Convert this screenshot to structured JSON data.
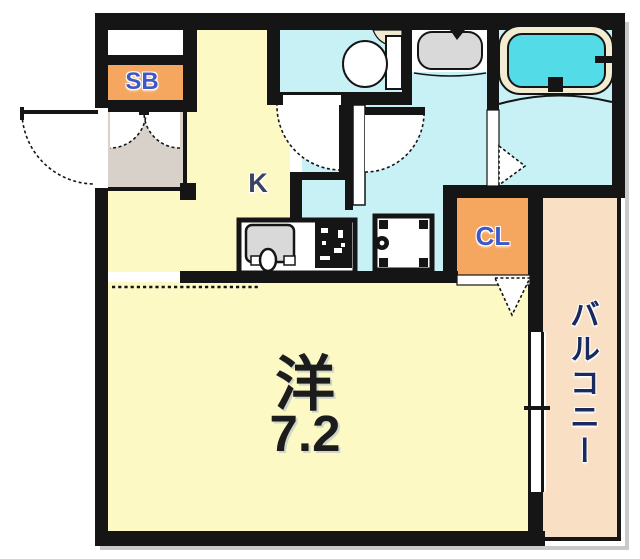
{
  "floor_plan": {
    "unit_labels": {
      "shoe_box": "SB",
      "kitchen": "K",
      "closet": "CL",
      "main_room_type": "洋",
      "main_room_size": "7.2",
      "balcony": "バルコニー"
    },
    "colors": {
      "wall": "#151515",
      "room_yellow": "#FCF9C5",
      "water_cyan": "#C8F1F6",
      "tub_water": "#54DBE8",
      "tub_rim": "#F1ECD2",
      "unit_orange": "#F5A75F",
      "balcony_peach": "#F9DFC3",
      "genkan_gray": "#D8D1CA",
      "fixture_gray": "#D9D9D9",
      "toilet_beige": "#EFE9D2",
      "shadow_gray": "#C9C9C9",
      "label_blue": "#3E57C9",
      "label_navy": "#1B2A5C",
      "label_slate": "#3A4161",
      "label_dark": "#1C1C1C"
    }
  }
}
